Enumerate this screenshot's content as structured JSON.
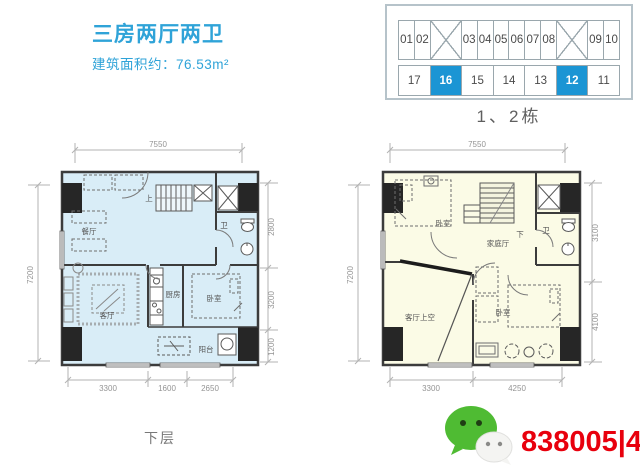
{
  "header": {
    "title": "三房两厅两卫",
    "subtitle": "建筑面积约：76.53m²"
  },
  "building_diagram": {
    "caption": "1、2栋",
    "highlight_color": "#1b95d4",
    "top_row": [
      {
        "label": "01",
        "span": 1
      },
      {
        "label": "02",
        "span": 1
      },
      {
        "type": "cross",
        "span": 2
      },
      {
        "label": "03",
        "span": 1
      },
      {
        "label": "04",
        "span": 1
      },
      {
        "label": "05",
        "span": 1
      },
      {
        "label": "06",
        "span": 1
      },
      {
        "label": "07",
        "span": 1
      },
      {
        "label": "08",
        "span": 1
      },
      {
        "type": "cross",
        "span": 2
      },
      {
        "label": "09",
        "span": 1
      },
      {
        "label": "10",
        "span": 1
      }
    ],
    "bottom_row": [
      {
        "label": "17",
        "highlight": false
      },
      {
        "label": "16",
        "highlight": true
      },
      {
        "label": "15",
        "highlight": false
      },
      {
        "label": "14",
        "highlight": false
      },
      {
        "label": "13",
        "highlight": false
      },
      {
        "label": "12",
        "highlight": true
      },
      {
        "label": "11",
        "highlight": false
      }
    ]
  },
  "plans": {
    "lower": {
      "fill": "#d9edf7",
      "caption": "下层",
      "rooms": {
        "dining": "餐厅",
        "living": "客厅",
        "kitchen": "厨房",
        "bedroom": "卧室",
        "bath": "卫",
        "balcony": "阳台",
        "stair": "上"
      },
      "dims": {
        "top": "7550",
        "side": "7200",
        "right": [
          "2800",
          "3200",
          "1200"
        ],
        "bottom": [
          "3300",
          "1600",
          "2650"
        ]
      }
    },
    "upper": {
      "fill": "#fbfbe6",
      "rooms": {
        "bedroom_top": "卧室",
        "family": "家庭厅",
        "bath": "卫",
        "void": "客厅上空",
        "bedroom_bottom": "卧室",
        "stair": "下"
      },
      "dims": {
        "top": "7550",
        "side": "7200",
        "right": [
          "3100",
          "4100"
        ],
        "bottom": [
          "3300",
          "4250"
        ]
      }
    }
  },
  "watermark": {
    "icon": "wechat-icon",
    "text": "838005|45",
    "text_color": "#e8000d",
    "green": "#4fbb33"
  }
}
